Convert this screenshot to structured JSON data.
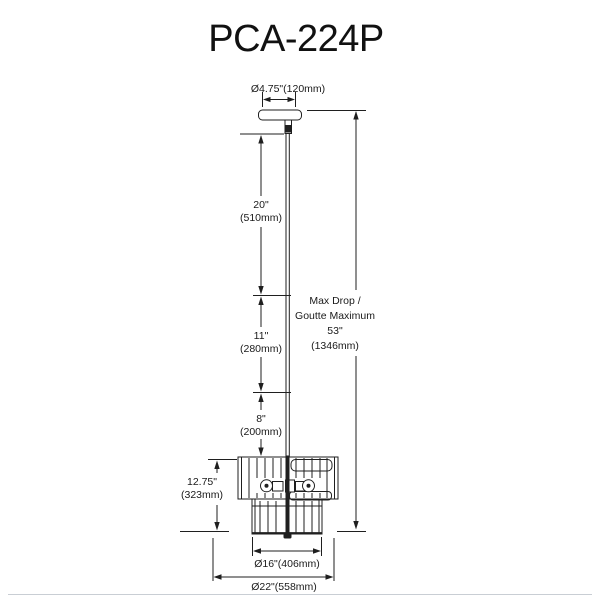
{
  "title": "PCA-224P",
  "colors": {
    "line": "#1f1f1f",
    "background": "#ffffff",
    "footer_rule": "#c9ced4"
  },
  "diagram": {
    "canopy_diameter": "Ø4.75\"(120mm)",
    "rod_segment_1": {
      "inches": "20\"",
      "mm": "(510mm)"
    },
    "rod_segment_2": {
      "inches": "11\"",
      "mm": "(280mm)"
    },
    "rod_segment_3": {
      "inches": "8\"",
      "mm": "(200mm)"
    },
    "max_drop": {
      "line1": "Max Drop /",
      "line2": "Goutte Maximum",
      "line3": "53\"",
      "line4": "(1346mm)"
    },
    "fixture_height": {
      "inches": "12.75\"",
      "mm": "(323mm)"
    },
    "inner_diameter": "Ø16\"(406mm)",
    "outer_diameter": "Ø22\"(558mm)"
  }
}
